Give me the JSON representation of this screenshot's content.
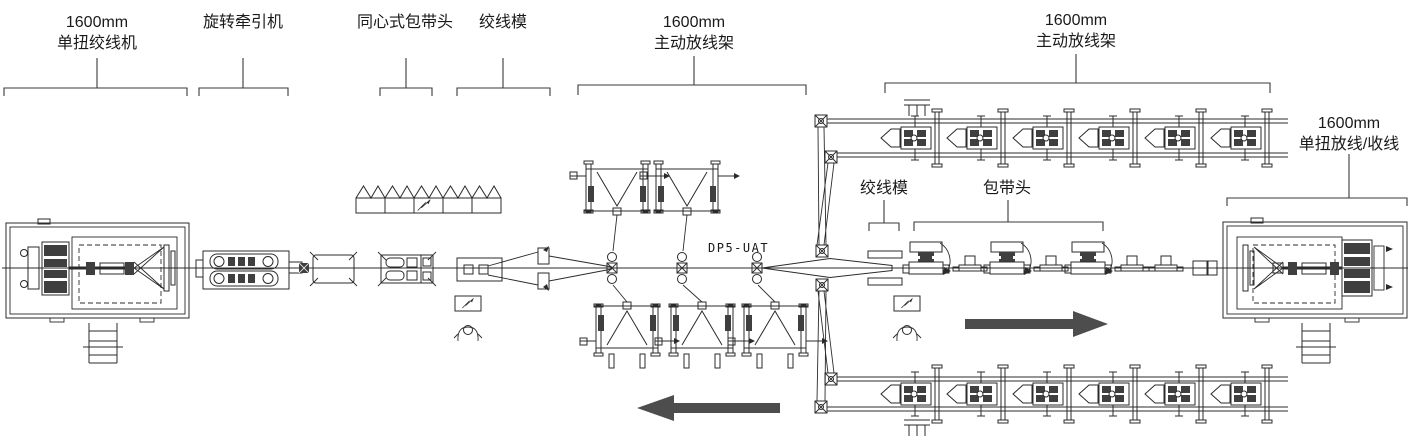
{
  "diagram_type": "cable-stranding-line-floor-plan",
  "labels": {
    "left_strander": {
      "line1": "1600mm",
      "line2": "单扭绞线机"
    },
    "rotary_capstan": {
      "text": "旋转牵引机"
    },
    "concentric_taping_head": {
      "text": "同心式包带头"
    },
    "stranding_die_left": {
      "text": "绞线模"
    },
    "center_payoff": {
      "line1": "1600mm",
      "line2": "主动放线架"
    },
    "right_payoff": {
      "line1": "1600mm",
      "line2": "主动放线架"
    },
    "right_takeup": {
      "line1": "1600mm",
      "line2": "单扭放线/收线"
    },
    "stranding_die_right": {
      "text": "绞线模"
    },
    "taping_head_right": {
      "text": "包带头"
    },
    "model_code": "DP5-UAT"
  },
  "icons": {
    "flow_arrow_left": "left-flow-arrow",
    "flow_arrow_right": "right-flow-arrow",
    "operator_station": "operator-figure",
    "break_mark": "cad-break-slash"
  },
  "colors": {
    "background": "#ffffff",
    "line_art": "#2b2b2b",
    "bracket": "#3a3a3a",
    "flow_arrow": "#4d4d4d",
    "model_text": "#979797",
    "dark_fill": "#3f3f3f"
  }
}
